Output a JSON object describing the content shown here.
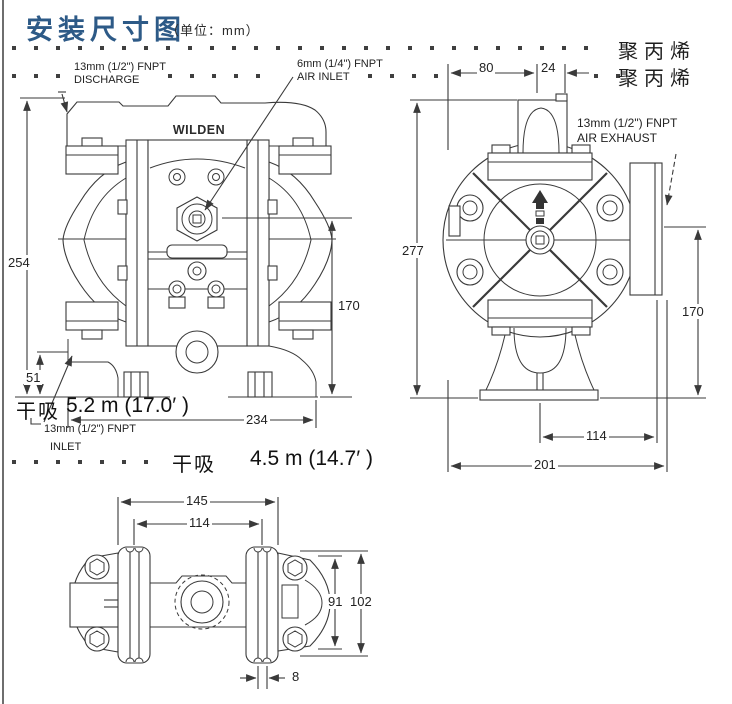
{
  "title": {
    "main": "安装尺寸图",
    "unit": "（单位：mm）"
  },
  "materials": {
    "row1": "聚丙烯",
    "row2": "聚丙烯"
  },
  "front_view": {
    "brand": "WILDEN",
    "discharge_label": {
      "line1": "13mm (1/2\") FNPT",
      "line2": "DISCHARGE"
    },
    "air_inlet_label": {
      "line1": "6mm (1/4\") FNPT",
      "line2": "AIR INLET"
    },
    "inlet_label": {
      "line1": "13mm (1/2\") FNPT",
      "line2": "INLET"
    },
    "dim_height": "254",
    "dim_inlet_height": "51",
    "dim_air_inlet_height": "170",
    "dim_width": "234",
    "dry_suction_label": "干吸",
    "dry_suction_value": "5.2 m (17.0′ )"
  },
  "side_view": {
    "air_exhaust_label": {
      "line1": "13mm (1/2\") FNPT",
      "line2": "AIR EXHAUST"
    },
    "dim_top_left": "80",
    "dim_top_right": "24",
    "dim_height": "277",
    "dim_exhaust_height": "170",
    "dim_base_width": "114",
    "dim_width": "201"
  },
  "dry_suction_note": {
    "label": "干吸",
    "value": "4.5 m (14.7′ )"
  },
  "bottom_view": {
    "dim_foot_outer": "145",
    "dim_foot_center": "114",
    "dim_inner": "91",
    "dim_overall": "102",
    "dim_slot": "8"
  },
  "colors": {
    "title_blue": "#2d5a87",
    "ink": "#3a3a3a"
  }
}
